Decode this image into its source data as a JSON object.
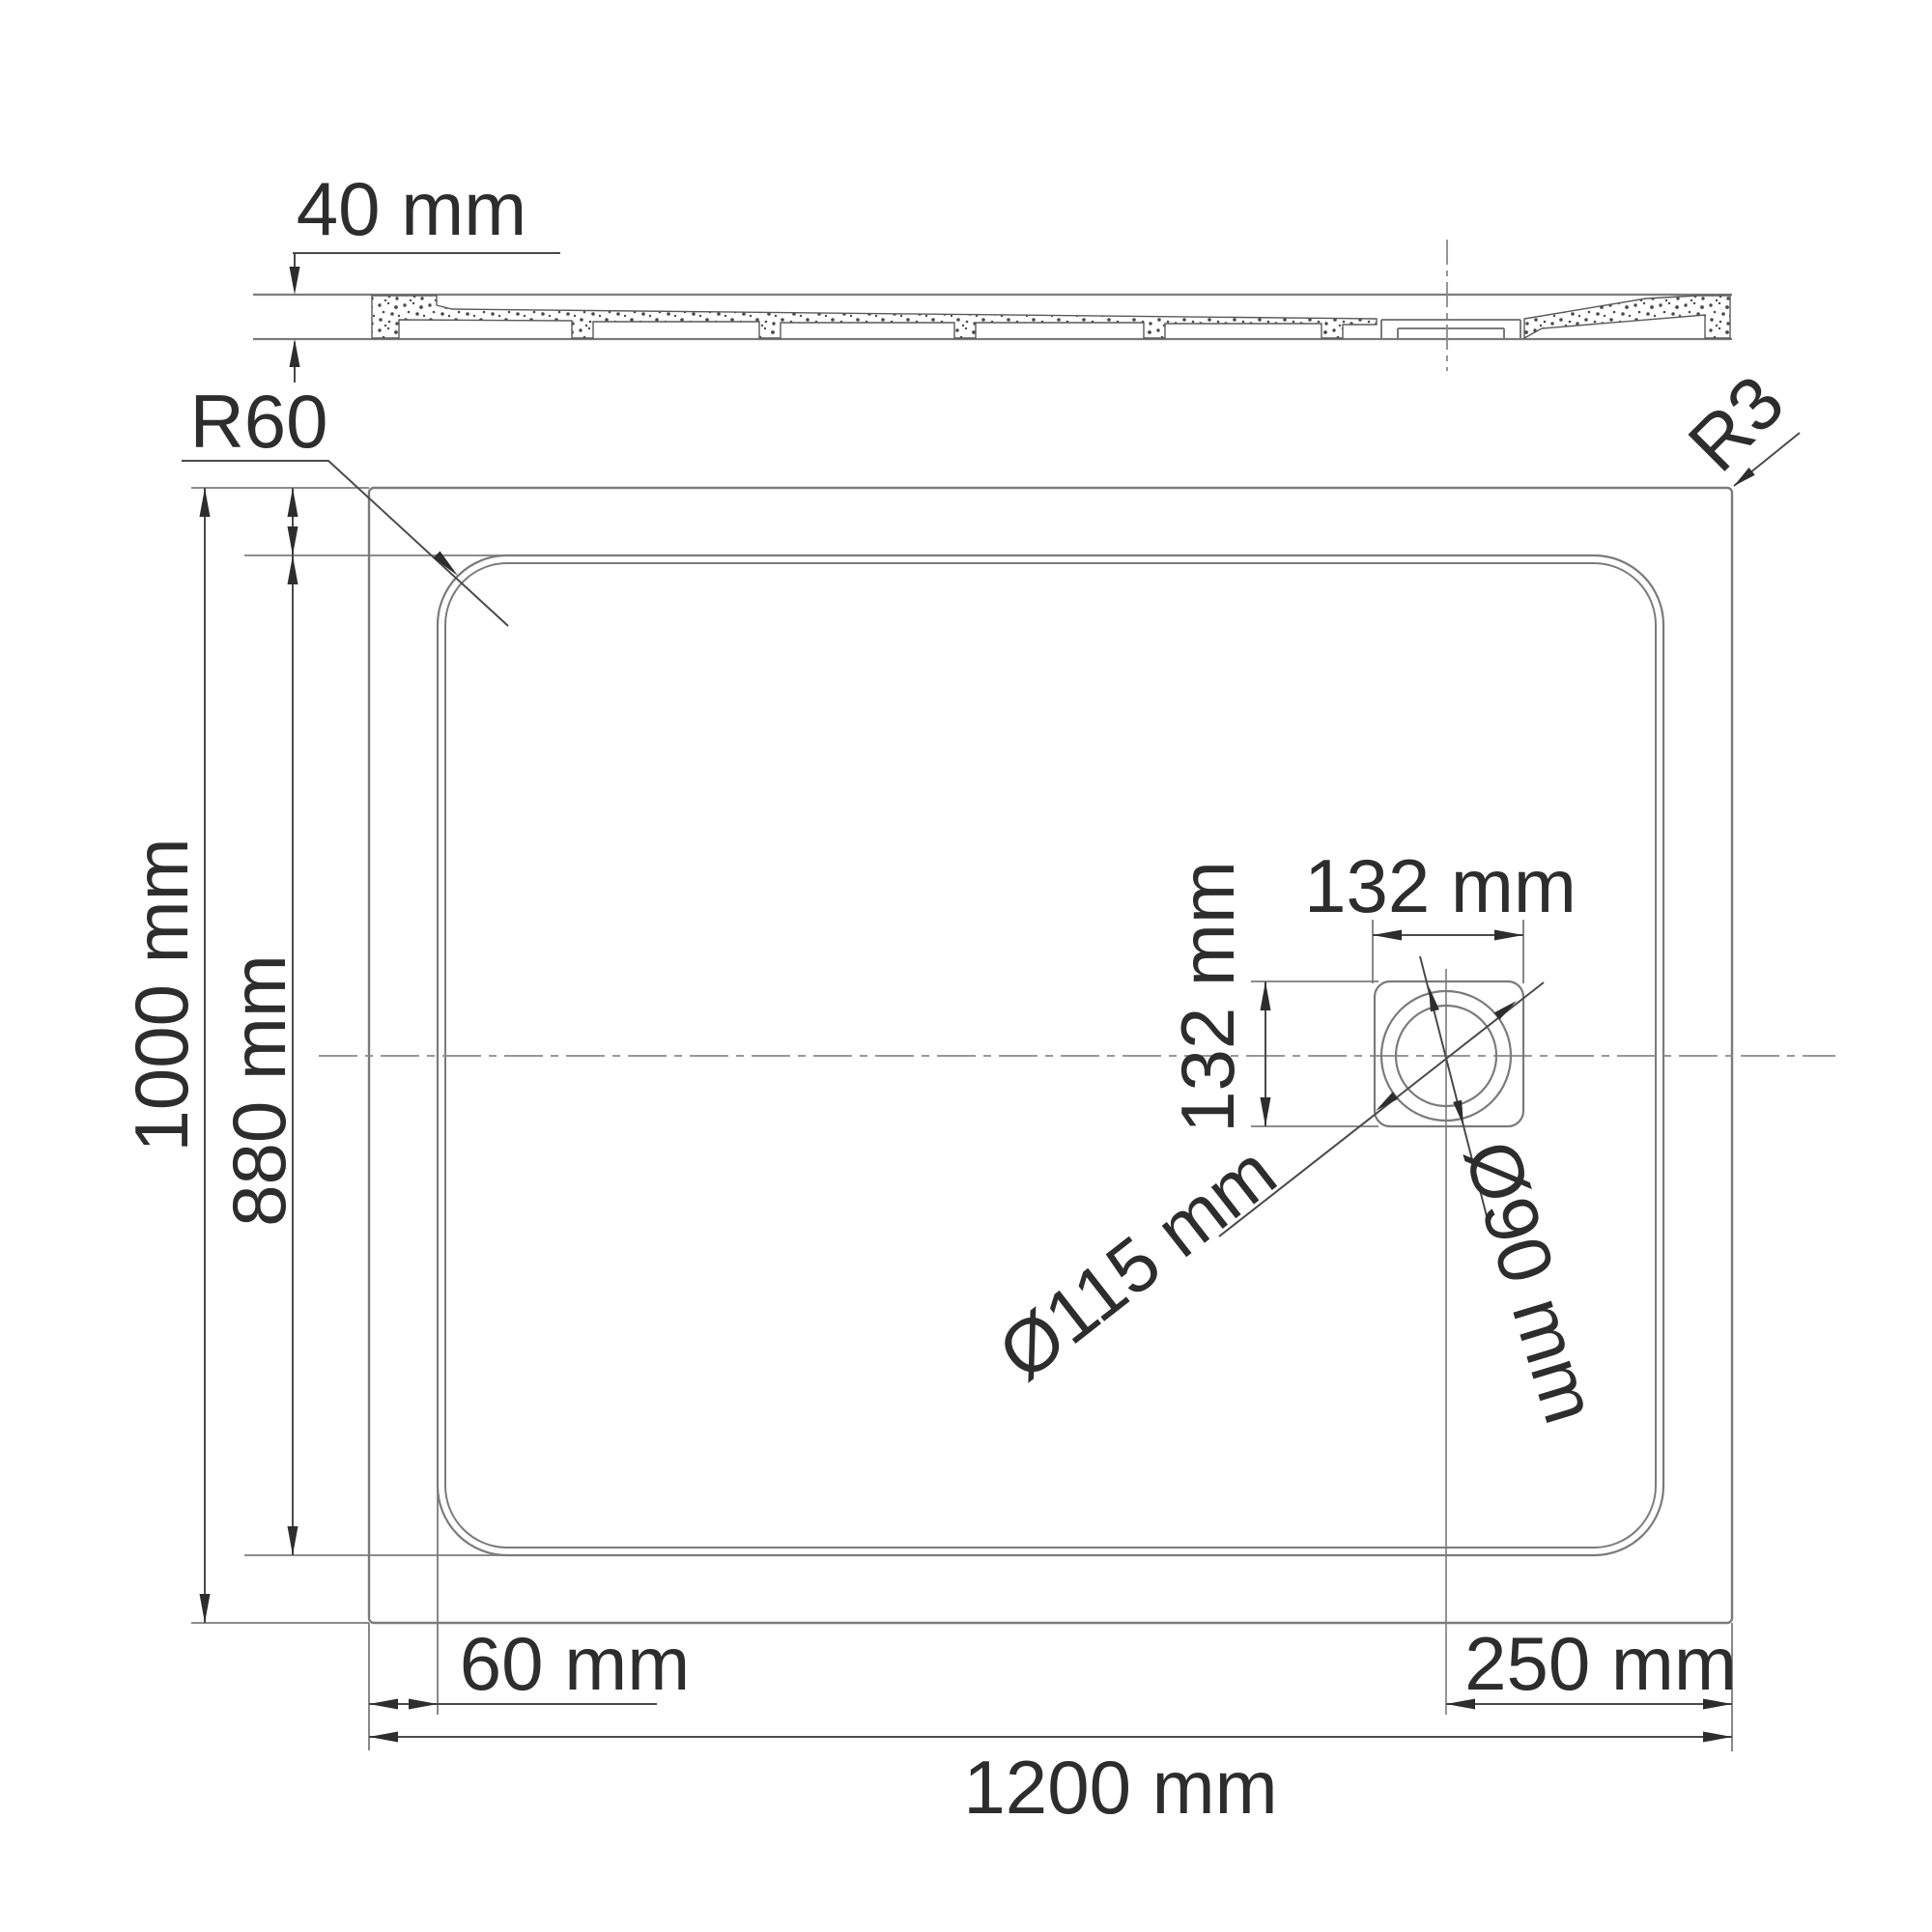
{
  "drawing": {
    "type": "technical-dimension-drawing",
    "subject": "rectangular shower tray, section view (top) and plan view (bottom)",
    "units": "mm",
    "colors": {
      "background": "#ffffff",
      "object_lines": "#7b7b7b",
      "dimension_lines": "#4a4a4a",
      "text": "#2d2d2d",
      "stipple": "#4a4a4a"
    }
  },
  "section_view": {
    "thickness_label": "40 mm"
  },
  "plan_view": {
    "inner_corner_radius_label": "R60",
    "outer_corner_radius_label": "R3",
    "overall_depth_label": "1000 mm",
    "inner_depth_label": "880 mm",
    "edge_offset_label": "60 mm",
    "overall_width_label": "1200 mm",
    "drain_to_edge_label": "250 mm",
    "drain_box_width_label": "132 mm",
    "drain_box_height_label": "132 mm",
    "drain_outer_diameter_label": "Ø115 mm",
    "drain_inner_diameter_label": "Ø90 mm"
  }
}
